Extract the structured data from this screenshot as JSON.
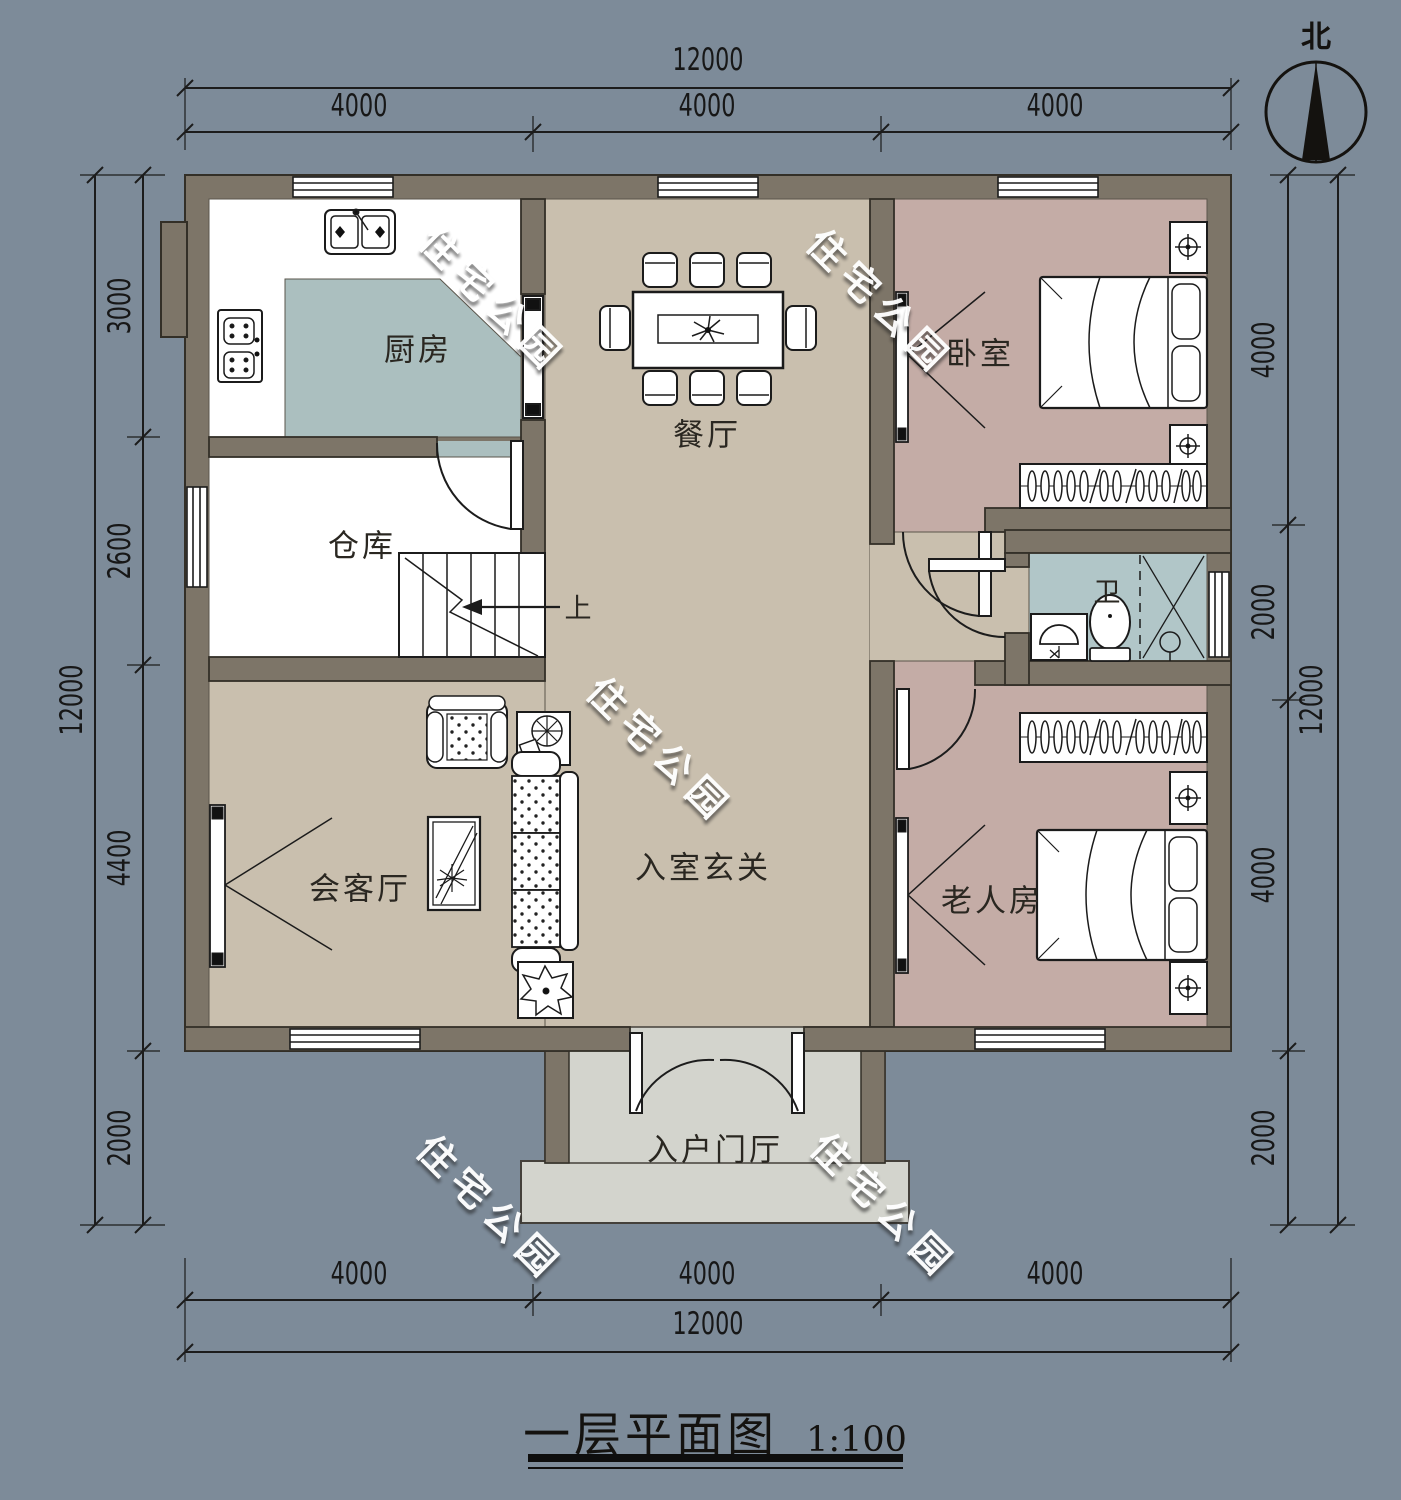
{
  "title": {
    "name": "一层平面图",
    "scale": "1:100"
  },
  "compass": {
    "north_label": "北"
  },
  "watermark": {
    "text": "住宅公园"
  },
  "rooms": {
    "kitchen": {
      "label": "厨房"
    },
    "dining": {
      "label": "餐厅"
    },
    "bedroom": {
      "label": "卧室"
    },
    "storage": {
      "label": "仓库"
    },
    "bathroom": {
      "label": "卫"
    },
    "living": {
      "label": "会客厅"
    },
    "entry_hall": {
      "label": "入室玄关"
    },
    "elder_room": {
      "label": "老人房"
    },
    "entry_foyer": {
      "label": "入户门厅"
    }
  },
  "stairs": {
    "up_label": "上"
  },
  "dimensions": {
    "top": {
      "total": "12000",
      "segments": [
        "4000",
        "4000",
        "4000"
      ]
    },
    "bottom": {
      "total": "12000",
      "segments": [
        "4000",
        "4000",
        "4000"
      ]
    },
    "left": {
      "total": "12000",
      "segments": [
        "3000",
        "2600",
        "4400",
        "2000"
      ]
    },
    "right": {
      "total": "12000",
      "segments": [
        "4000",
        "2000",
        "4000",
        "2000"
      ]
    }
  },
  "colors": {
    "background": "#7d8b99",
    "wall": "#7d7568",
    "floor_hall": "#c9bfae",
    "floor_kitchen": "#abbfbf",
    "floor_bathroom": "#b1c6c8",
    "floor_bedroom": "#c4aca6",
    "floor_foyer": "#d3d4cd",
    "line": "#1c1c1c"
  }
}
